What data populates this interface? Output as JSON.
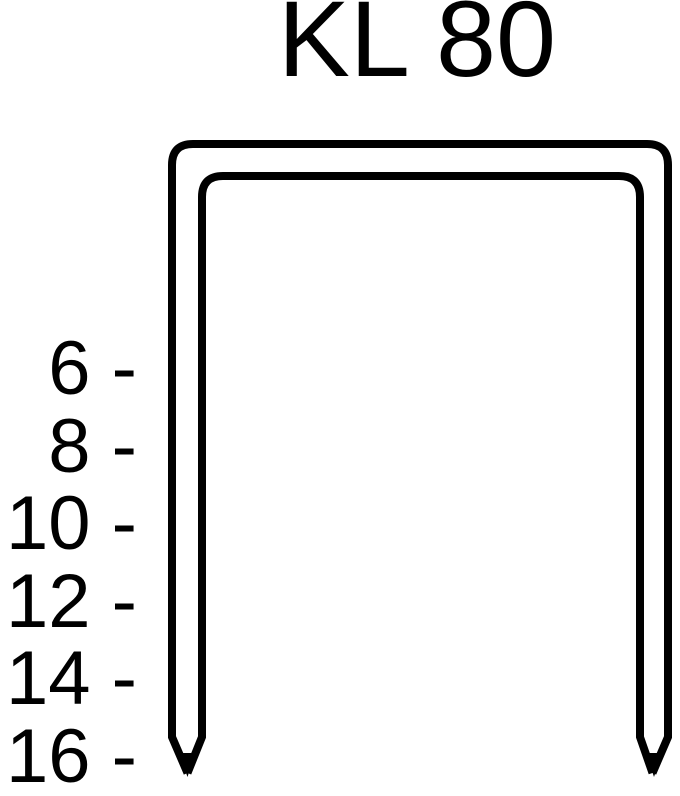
{
  "title": "KL 80",
  "scale": {
    "items": [
      "6 -",
      "8 -",
      "10 -",
      "12 -",
      "14 -",
      "16 -"
    ],
    "values": [
      6,
      8,
      10,
      12,
      14,
      16
    ]
  },
  "diagram": {
    "line_color": "#000000",
    "background_color": "#ffffff"
  }
}
